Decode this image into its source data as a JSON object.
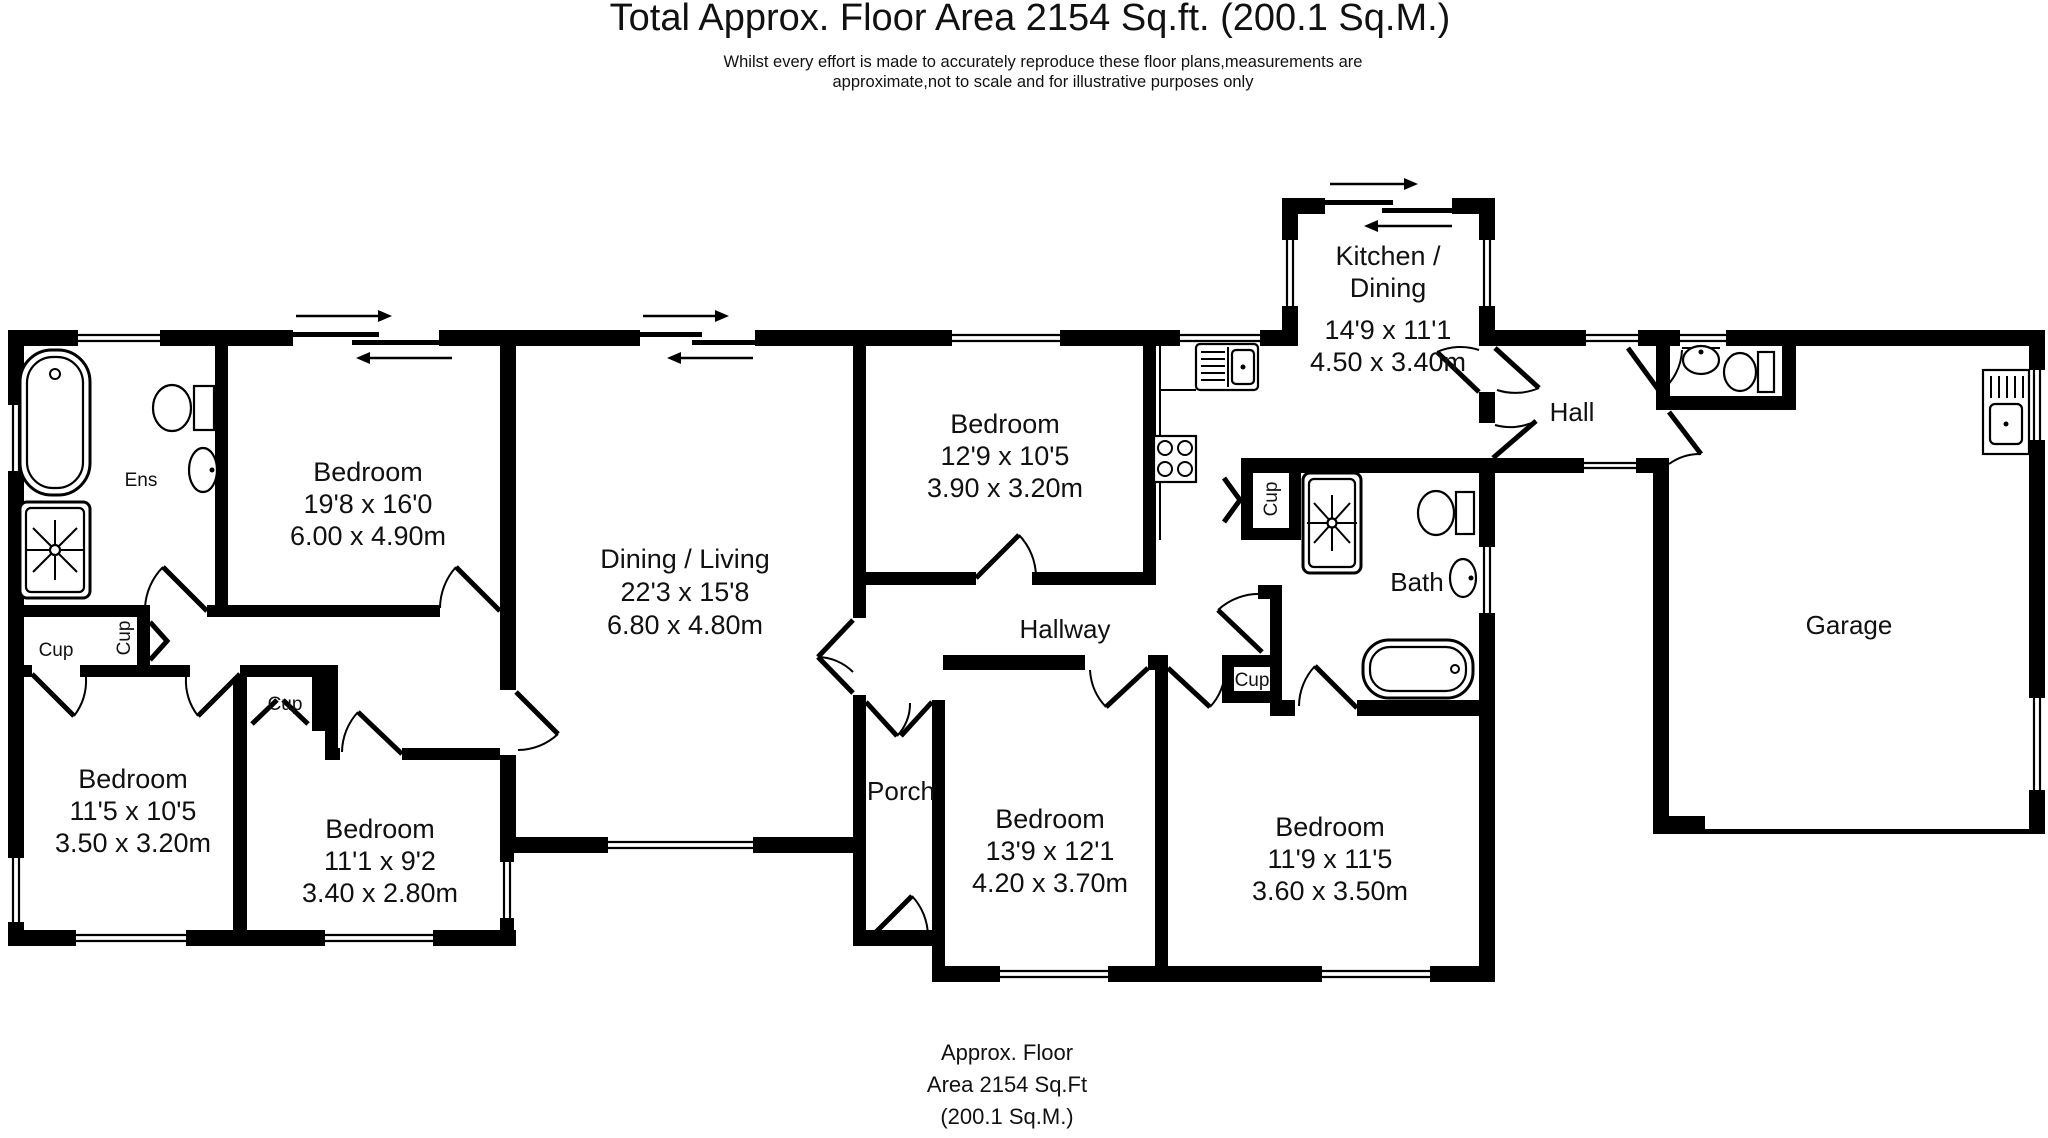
{
  "title": "Total Approx. Floor Area 2154 Sq.ft. (200.1 Sq.M.)",
  "disclaimer": {
    "line1": "Whilst every effort is made to accurately reproduce these floor plans,measurements are",
    "line2": "approximate,not to scale and for illustrative purposes only"
  },
  "footer": {
    "line1": "Approx. Floor",
    "line2": "Area 2154 Sq.Ft",
    "line3": "(200.1 Sq.M.)"
  },
  "labels": {
    "ensuite": "Ens",
    "cupboard": "Cup",
    "hall": "Hall",
    "hallway": "Hallway",
    "porch": "Porch",
    "bath": "Bath",
    "garage": "Garage"
  },
  "rooms": {
    "bedroom_main": {
      "name": "Bedroom",
      "imperial": "19'8 x 16'0",
      "metric": "6.00 x 4.90m"
    },
    "dining_living": {
      "name": "Dining / Living",
      "imperial": "22'3 x 15'8",
      "metric": "6.80 x 4.80m"
    },
    "bedroom_2": {
      "name": "Bedroom",
      "imperial": "12'9 x 10'5",
      "metric": "3.90 x 3.20m"
    },
    "kitchen_dining": {
      "name_line1": "Kitchen /",
      "name_line2": "Dining",
      "imperial": "14'9 x 11'1",
      "metric": "4.50 x 3.40m"
    },
    "bedroom_3": {
      "name": "Bedroom",
      "imperial": "11'5 x 10'5",
      "metric": "3.50 x 3.20m"
    },
    "bedroom_4": {
      "name": "Bedroom",
      "imperial": "11'1 x 9'2",
      "metric": "3.40 x 2.80m"
    },
    "bedroom_5": {
      "name": "Bedroom",
      "imperial": "13'9 x 12'1",
      "metric": "4.20 x 3.70m"
    },
    "bedroom_6": {
      "name": "Bedroom",
      "imperial": "11'9 x 11'5",
      "metric": "3.60 x 3.50m"
    }
  },
  "colors": {
    "wall": "#000000",
    "background": "#ffffff",
    "text": "#111111"
  }
}
